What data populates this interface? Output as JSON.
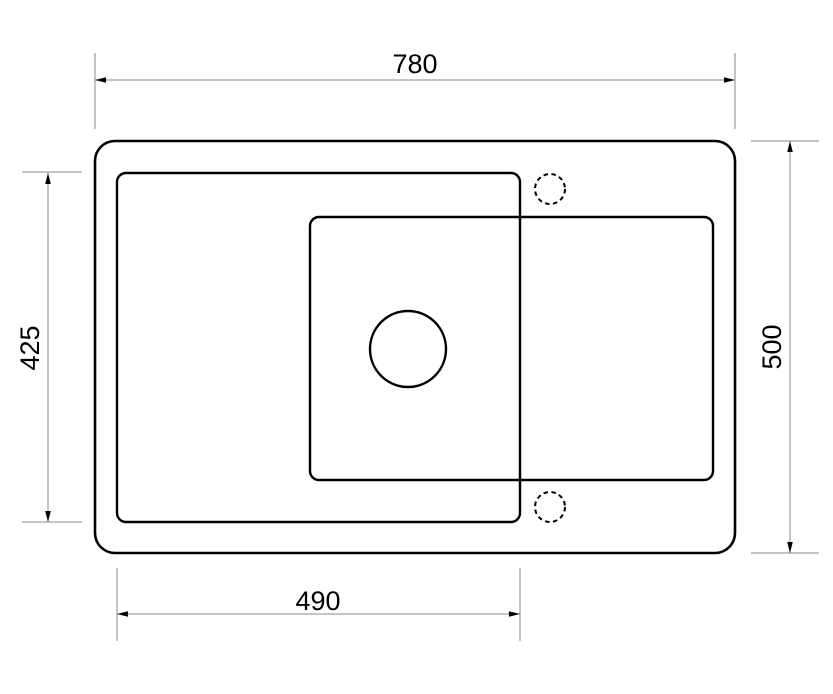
{
  "page": {
    "width": 833,
    "height": 694,
    "background": "#ffffff"
  },
  "drawing": {
    "kind": "technical-drawing-sink-top-view",
    "line_color": "#000000",
    "dim_line_color": "#8a8a8a",
    "text_color": "#000000",
    "font_size": 27,
    "arrow": {
      "length": 11,
      "half_width": 2.8
    },
    "shapes": {
      "outer_rim": {
        "name": "sink-outer-rim",
        "x": 95,
        "y": 141,
        "w": 640,
        "h": 412,
        "r": 20,
        "sw": 2.6
      },
      "drainer": {
        "name": "drainer-board-outline",
        "x": 117,
        "y": 173,
        "w": 403,
        "h": 349,
        "r": 9,
        "sw": 2.4
      },
      "bowl": {
        "name": "bowl-outline",
        "x": 310,
        "y": 217,
        "w": 403,
        "h": 263,
        "r": 9,
        "sw": 2.4
      },
      "drain_hole": {
        "name": "drain-hole",
        "cx": 408,
        "cy": 349,
        "r": 38,
        "sw": 2.4
      },
      "tap_holes": [
        {
          "name": "tap-hole-top",
          "cx": 550,
          "cy": 189,
          "r": 15,
          "sw": 2,
          "dash": "4.5 3.5"
        },
        {
          "name": "tap-hole-bottom",
          "cx": 550,
          "cy": 507,
          "r": 15,
          "sw": 2,
          "dash": "4.5 3.5"
        }
      ]
    },
    "dimensions": [
      {
        "id": "overall-width",
        "value": "780",
        "axis": "h",
        "line": [
          95,
          80,
          735,
          80
        ],
        "ext": [
          [
            95,
            53,
            95,
            129
          ],
          [
            735,
            53,
            735,
            129
          ]
        ],
        "label": {
          "x": 415,
          "y": 73,
          "rotate": 0
        }
      },
      {
        "id": "overall-depth",
        "value": "500",
        "axis": "v",
        "line": [
          790,
          141,
          790,
          553
        ],
        "ext": [
          [
            751,
            141,
            819,
            141
          ],
          [
            751,
            553,
            819,
            553
          ]
        ],
        "label": {
          "x": 781,
          "y": 347,
          "rotate": -90
        }
      },
      {
        "id": "drainer-depth",
        "value": "425",
        "axis": "v",
        "line": [
          48,
          173,
          48,
          522
        ],
        "ext": [
          [
            22,
            172,
            82,
            172
          ],
          [
            22,
            522,
            82,
            522
          ]
        ],
        "label": {
          "x": 39,
          "y": 348,
          "rotate": -90
        }
      },
      {
        "id": "drainer-width",
        "value": "490",
        "axis": "h",
        "line": [
          117,
          614,
          520,
          614
        ],
        "ext": [
          [
            117,
            568,
            117,
            641
          ],
          [
            520,
            568,
            520,
            641
          ]
        ],
        "label": {
          "x": 318,
          "y": 610,
          "rotate": 0
        }
      }
    ]
  }
}
